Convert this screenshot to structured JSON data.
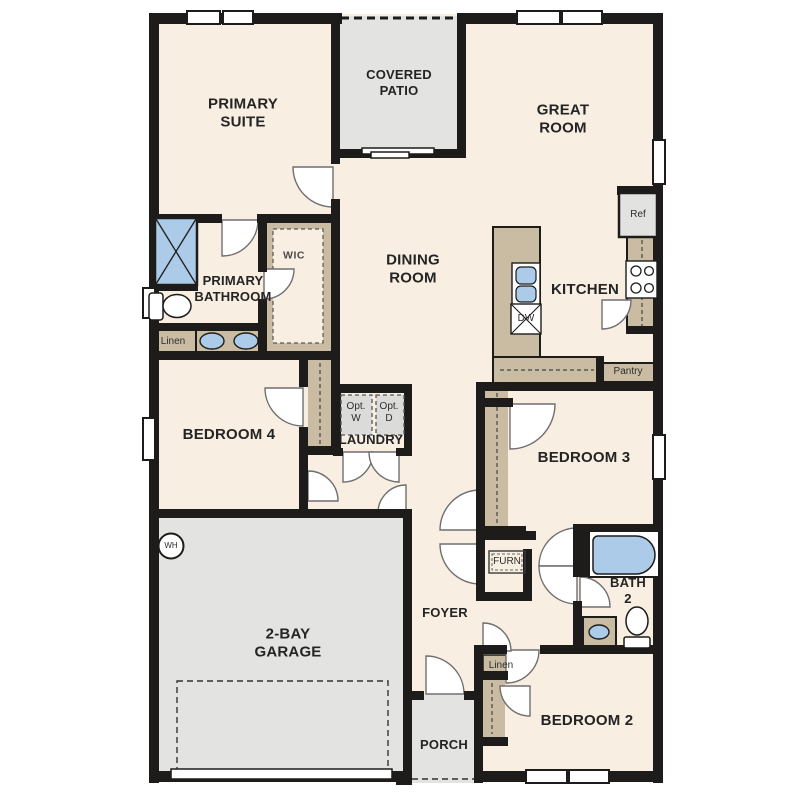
{
  "plan": {
    "rooms": {
      "primary_suite": "PRIMARY\nSUITE",
      "covered_patio": "COVERED\nPATIO",
      "great_room": "GREAT\nROOM",
      "dining_room": "DINING\nROOM",
      "kitchen": "KITCHEN",
      "primary_bathroom": "PRIMARY\nBATHROOM",
      "wic": "WIC",
      "bedroom_4": "BEDROOM 4",
      "laundry": "LAUNDRY",
      "bedroom_3": "BEDROOM 3",
      "garage": "2-BAY\nGARAGE",
      "foyer": "FOYER",
      "bath_2": "BATH\n2",
      "bedroom_2": "BEDROOM 2",
      "porch": "PORCH"
    },
    "fixtures": {
      "refrigerator": "Ref",
      "dishwasher": "DW",
      "pantry": "Pantry",
      "linen_primary": "Linen",
      "linen_hall": "Linen",
      "optional_washer": "Opt.\nW",
      "optional_dryer": "Opt.\nD",
      "furnace": "FURN",
      "water_heater": "WH"
    },
    "colors": {
      "wall": "#1d1c1a",
      "floor": "#f8eee2",
      "patio_concrete": "#e3e3e1",
      "cabinetry_tan": "#c9bca3",
      "plumbing_blue": "#abcbe9",
      "optional_appliance_fill": "#dbdbd9",
      "background": "#ffffff"
    }
  }
}
